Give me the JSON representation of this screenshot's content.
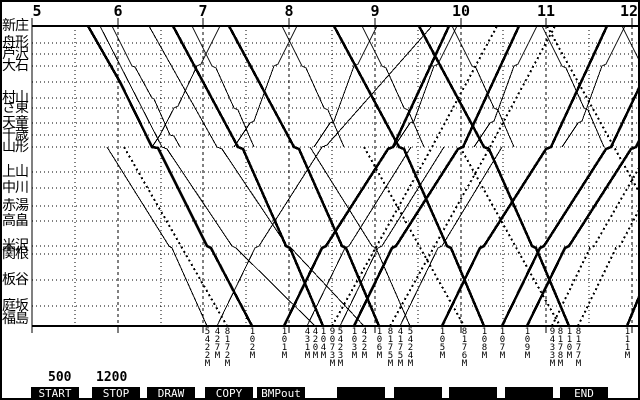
{
  "colors": {
    "fg": "#000000",
    "bg": "#ffffff",
    "fkey_bg": "#000000",
    "fkey_fg": "#ffffff"
  },
  "time_axis": {
    "hours": [
      "5",
      "6",
      "7",
      "8",
      "9",
      "10",
      "11",
      "12"
    ],
    "hour_x": [
      30,
      116,
      201,
      287,
      373,
      459,
      544,
      630
    ],
    "label_x": [
      35,
      116,
      201,
      287,
      373,
      459,
      544,
      627
    ],
    "half_hour_x": [
      73,
      159,
      244,
      330,
      416,
      501,
      587
    ]
  },
  "frame": {
    "left_x": 30,
    "right_x": 636,
    "top_y": 24,
    "bottom_y": 324,
    "axis_top_y": 16,
    "tick_below_y": 331
  },
  "stations": [
    {
      "name": "新庄",
      "y": 24
    },
    {
      "name": "舟形",
      "y": 41
    },
    {
      "name": "芦沢",
      "y": 52
    },
    {
      "name": "大石",
      "y": 64
    },
    {
      "name": "村山",
      "y": 96
    },
    {
      "name": "さ東",
      "y": 106
    },
    {
      "name": "天童",
      "y": 121
    },
    {
      "name": "千歳",
      "y": 133
    },
    {
      "name": "山形",
      "y": 145
    },
    {
      "name": "上山",
      "y": 170
    },
    {
      "name": "中川",
      "y": 186
    },
    {
      "name": "赤湯",
      "y": 204
    },
    {
      "name": "高畠",
      "y": 219
    },
    {
      "name": "米沢",
      "y": 244
    },
    {
      "name": "関根",
      "y": 252
    },
    {
      "name": "板谷",
      "y": 278
    },
    {
      "name": "庭坂",
      "y": 304
    },
    {
      "name": "福島",
      "y": 317
    }
  ],
  "extra_row_y": [
    80
  ],
  "trains": [
    {
      "no": "5422M",
      "style": "thin",
      "label_x": 205,
      "points": [
        [
          105,
          145
        ],
        [
          167,
          244
        ],
        [
          170,
          246
        ],
        [
          205,
          324
        ]
      ]
    },
    {
      "no": "427M",
      "style": "thin",
      "label_x": 215,
      "points": [
        [
          215,
          324
        ],
        [
          253,
          246
        ],
        [
          257,
          244
        ],
        [
          320,
          145
        ],
        [
          325,
          143
        ],
        [
          430,
          24
        ]
      ]
    },
    {
      "no": "8172M",
      "style": "dotted",
      "label_x": 225,
      "points": [
        [
          122,
          145
        ],
        [
          225,
          324
        ]
      ]
    },
    {
      "no": "102M",
      "style": "thick",
      "label_x": 250,
      "points": [
        [
          86,
          24
        ],
        [
          118,
          80
        ],
        [
          150,
          145
        ],
        [
          156,
          146
        ],
        [
          205,
          244
        ],
        [
          209,
          246
        ],
        [
          250,
          324
        ]
      ]
    },
    {
      "no": "101M",
      "style": "thick",
      "label_x": 282,
      "points": [
        [
          282,
          324
        ],
        [
          320,
          246
        ],
        [
          324,
          244
        ],
        [
          386,
          147
        ],
        [
          391,
          145
        ],
        [
          447,
          24
        ]
      ]
    },
    {
      "no": "431M",
      "style": "thin",
      "label_x": 305,
      "points": [
        [
          305,
          324
        ],
        [
          343,
          246
        ],
        [
          347,
          244
        ],
        [
          409,
          145
        ]
      ]
    },
    {
      "no": "420M",
      "style": "thin",
      "label_x": 313,
      "points": [
        [
          98,
          24
        ],
        [
          160,
          145
        ],
        [
          165,
          147
        ],
        [
          230,
          244
        ],
        [
          234,
          246
        ],
        [
          313,
          324
        ]
      ]
    },
    {
      "no": "104M",
      "style": "thick",
      "label_x": 321,
      "points": [
        [
          171,
          24
        ],
        [
          236,
          145
        ],
        [
          241,
          147
        ],
        [
          284,
          244
        ],
        [
          288,
          246
        ],
        [
          321,
          324
        ]
      ]
    },
    {
      "no": "9073M",
      "style": "dotted",
      "label_x": 330,
      "points": [
        [
          330,
          324
        ],
        [
          430,
          145
        ],
        [
          495,
          24
        ]
      ]
    },
    {
      "no": "5423M",
      "style": "thin",
      "label_x": 338,
      "points": [
        [
          338,
          324
        ],
        [
          376,
          246
        ],
        [
          380,
          244
        ],
        [
          442,
          145
        ]
      ]
    },
    {
      "no": "103M",
      "style": "thick",
      "label_x": 352,
      "points": [
        [
          352,
          324
        ],
        [
          390,
          246
        ],
        [
          394,
          244
        ],
        [
          456,
          147
        ],
        [
          461,
          145
        ],
        [
          517,
          24
        ]
      ]
    },
    {
      "no": "422M",
      "style": "thin",
      "label_x": 362,
      "points": [
        [
          147,
          24
        ],
        [
          215,
          145
        ],
        [
          220,
          147
        ],
        [
          285,
          244
        ],
        [
          289,
          246
        ],
        [
          362,
          324
        ]
      ]
    },
    {
      "no": "106M",
      "style": "thick",
      "label_x": 377,
      "points": [
        [
          227,
          24
        ],
        [
          292,
          145
        ],
        [
          297,
          147
        ],
        [
          340,
          244
        ],
        [
          344,
          246
        ],
        [
          377,
          324
        ]
      ]
    },
    {
      "no": "8175M",
      "style": "dotted",
      "label_x": 388,
      "points": [
        [
          388,
          324
        ],
        [
          488,
          145
        ],
        [
          553,
          24
        ]
      ]
    },
    {
      "no": "4175M",
      "style": "thin",
      "label_x": 398,
      "points": [
        [
          398,
          324
        ],
        [
          436,
          246
        ],
        [
          440,
          244
        ],
        [
          500,
          145
        ]
      ]
    },
    {
      "no": "5424M",
      "style": "thin",
      "label_x": 408,
      "points": [
        [
          308,
          145
        ],
        [
          370,
          244
        ],
        [
          374,
          246
        ],
        [
          408,
          324
        ]
      ]
    },
    {
      "no": "105M",
      "style": "thick",
      "label_x": 440,
      "points": [
        [
          440,
          324
        ],
        [
          478,
          246
        ],
        [
          482,
          244
        ],
        [
          544,
          147
        ],
        [
          549,
          145
        ],
        [
          605,
          24
        ]
      ]
    },
    {
      "no": "8176M",
      "style": "dotted",
      "label_x": 462,
      "points": [
        [
          362,
          145
        ],
        [
          462,
          324
        ]
      ]
    },
    {
      "no": "108M",
      "style": "thick",
      "label_x": 482,
      "points": [
        [
          332,
          24
        ],
        [
          397,
          145
        ],
        [
          402,
          147
        ],
        [
          445,
          244
        ],
        [
          449,
          246
        ],
        [
          482,
          324
        ]
      ]
    },
    {
      "no": "107M",
      "style": "thick",
      "label_x": 500,
      "points": [
        [
          500,
          324
        ],
        [
          538,
          246
        ],
        [
          542,
          244
        ],
        [
          604,
          147
        ],
        [
          609,
          145
        ],
        [
          637,
          86
        ]
      ]
    },
    {
      "no": "109M",
      "style": "thick",
      "label_x": 525,
      "points": [
        [
          525,
          324
        ],
        [
          563,
          246
        ],
        [
          567,
          244
        ],
        [
          629,
          147
        ],
        [
          634,
          145
        ],
        [
          637,
          139
        ]
      ]
    },
    {
      "no": "9433M",
      "style": "dotted",
      "label_x": 550,
      "points": [
        [
          550,
          324
        ],
        [
          588,
          246
        ],
        [
          592,
          244
        ],
        [
          637,
          166
        ]
      ]
    },
    {
      "no": "8178M",
      "style": "dotted",
      "label_x": 558,
      "points": [
        [
          458,
          145
        ],
        [
          558,
          324
        ]
      ]
    },
    {
      "no": "110M",
      "style": "thick",
      "label_x": 567,
      "points": [
        [
          417,
          24
        ],
        [
          482,
          145
        ],
        [
          487,
          147
        ],
        [
          530,
          244
        ],
        [
          534,
          246
        ],
        [
          567,
          324
        ]
      ]
    },
    {
      "no": "8177M",
      "style": "dotted",
      "label_x": 576,
      "points": [
        [
          576,
          324
        ],
        [
          614,
          246
        ],
        [
          618,
          244
        ],
        [
          637,
          208
        ]
      ]
    },
    {
      "no": "111M",
      "style": "thick",
      "label_x": 625,
      "points": [
        [
          625,
          324
        ],
        [
          637,
          295
        ]
      ]
    },
    {
      "no": "",
      "style": "dotted",
      "label_x": null,
      "points": [
        [
          545,
          24
        ],
        [
          637,
          190
        ]
      ]
    },
    {
      "no": "",
      "style": "thin",
      "label_x": null,
      "points": [
        [
          110,
          24
        ],
        [
          130,
          64
        ],
        [
          133,
          65
        ],
        [
          150,
          96
        ],
        [
          152,
          97
        ],
        [
          168,
          133
        ],
        [
          172,
          134
        ],
        [
          178,
          145
        ]
      ]
    },
    {
      "no": "",
      "style": "thin",
      "label_x": null,
      "points": [
        [
          150,
          145
        ],
        [
          158,
          133
        ],
        [
          172,
          106
        ],
        [
          176,
          104
        ],
        [
          195,
          64
        ],
        [
          199,
          62
        ],
        [
          218,
          24
        ]
      ]
    },
    {
      "no": "",
      "style": "thin",
      "label_x": null,
      "points": [
        [
          190,
          24
        ],
        [
          210,
          64
        ],
        [
          214,
          66
        ],
        [
          232,
          106
        ],
        [
          236,
          108
        ],
        [
          252,
          145
        ]
      ]
    },
    {
      "no": "",
      "style": "thin",
      "label_x": null,
      "points": [
        [
          232,
          145
        ],
        [
          248,
          121
        ],
        [
          252,
          119
        ],
        [
          272,
          64
        ],
        [
          276,
          62
        ],
        [
          295,
          24
        ]
      ]
    },
    {
      "no": "",
      "style": "thin",
      "label_x": null,
      "points": [
        [
          280,
          24
        ],
        [
          300,
          64
        ],
        [
          304,
          66
        ],
        [
          322,
          106
        ],
        [
          326,
          108
        ],
        [
          342,
          145
        ]
      ]
    },
    {
      "no": "",
      "style": "thin",
      "label_x": null,
      "points": [
        [
          312,
          145
        ],
        [
          328,
          121
        ],
        [
          332,
          119
        ],
        [
          352,
          64
        ],
        [
          356,
          62
        ],
        [
          375,
          24
        ]
      ]
    },
    {
      "no": "",
      "style": "thin",
      "label_x": null,
      "points": [
        [
          360,
          24
        ],
        [
          380,
          64
        ],
        [
          384,
          66
        ],
        [
          402,
          106
        ],
        [
          406,
          108
        ],
        [
          422,
          145
        ]
      ]
    },
    {
      "no": "",
      "style": "thin",
      "label_x": null,
      "points": [
        [
          392,
          145
        ],
        [
          408,
          121
        ],
        [
          412,
          119
        ],
        [
          432,
          64
        ],
        [
          436,
          62
        ],
        [
          455,
          24
        ]
      ]
    },
    {
      "no": "",
      "style": "thin",
      "label_x": null,
      "points": [
        [
          450,
          24
        ],
        [
          470,
          64
        ],
        [
          474,
          66
        ],
        [
          492,
          106
        ],
        [
          496,
          108
        ],
        [
          512,
          145
        ]
      ]
    },
    {
      "no": "",
      "style": "thin",
      "label_x": null,
      "points": [
        [
          472,
          145
        ],
        [
          488,
          121
        ],
        [
          492,
          119
        ],
        [
          512,
          64
        ],
        [
          516,
          62
        ],
        [
          535,
          24
        ]
      ]
    },
    {
      "no": "",
      "style": "thin",
      "label_x": null,
      "points": [
        [
          540,
          24
        ],
        [
          560,
          64
        ],
        [
          564,
          66
        ],
        [
          582,
          106
        ],
        [
          586,
          108
        ],
        [
          602,
          145
        ]
      ]
    },
    {
      "no": "",
      "style": "thin",
      "label_x": null,
      "points": [
        [
          560,
          145
        ],
        [
          576,
          121
        ],
        [
          580,
          119
        ],
        [
          600,
          64
        ],
        [
          604,
          62
        ],
        [
          623,
          24
        ]
      ]
    },
    {
      "no": "",
      "style": "thin",
      "label_x": null,
      "points": [
        [
          620,
          24
        ],
        [
          637,
          58
        ]
      ]
    }
  ],
  "train_label_top_y": 326,
  "params": [
    {
      "value": "500",
      "x": 46
    },
    {
      "value": "1200",
      "x": 94
    }
  ],
  "function_keys": [
    {
      "label": "START",
      "x": 29
    },
    {
      "label": "STOP",
      "x": 90
    },
    {
      "label": "DRAW",
      "x": 145
    },
    {
      "label": "COPY",
      "x": 203
    },
    {
      "label": "BMPout",
      "x": 255
    },
    {
      "label": "",
      "x": 335
    },
    {
      "label": "",
      "x": 392
    },
    {
      "label": "",
      "x": 447
    },
    {
      "label": "",
      "x": 503
    },
    {
      "label": "END",
      "x": 558
    }
  ]
}
